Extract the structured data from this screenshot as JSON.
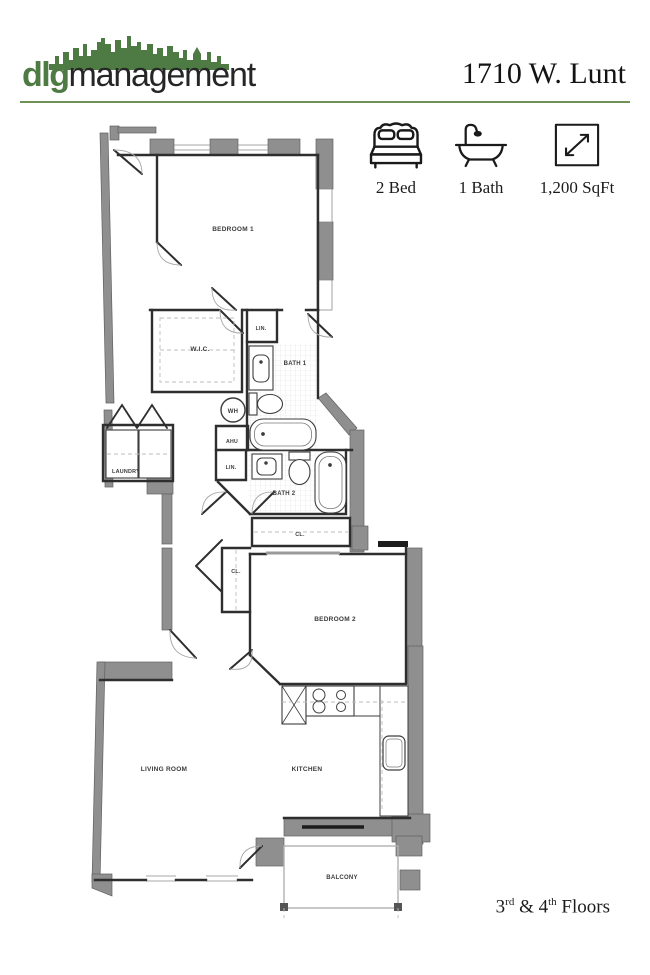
{
  "header": {
    "logo_bold": "dlg",
    "logo_rest": "management",
    "title": "1710 W. Lunt"
  },
  "features": [
    {
      "icon": "bed-icon",
      "label": "2 Bed"
    },
    {
      "icon": "bathtub-icon",
      "label": "1 Bath"
    },
    {
      "icon": "dimensions-icon",
      "label": "1,200 SqFt"
    }
  ],
  "floorplan": {
    "labels": {
      "bedroom1": "BEDROOM 1",
      "wic": "W.I.C.",
      "lin1": "LIN.",
      "bath1": "BATH 1",
      "wh": "WH",
      "ahu": "AHU",
      "laundry": "LAUNDRY",
      "lin2": "LIN.",
      "bath2": "BATH 2",
      "cl1": "CL.",
      "cl2": "CL.",
      "bedroom2": "BEDROOM 2",
      "living_room": "LIVING ROOM",
      "kitchen": "KITCHEN",
      "balcony": "BALCONY"
    }
  },
  "footer": {
    "floor_num_1": "3",
    "floor_sup_1": "rd",
    "separator": " & ",
    "floor_num_2": "4",
    "floor_sup_2": "th",
    "suffix": " Floors"
  },
  "palette": {
    "brand_green": "#4e7b44",
    "rule_green": "#6f9257",
    "wall_gray": "#8f8f8f",
    "line_dark": "#2e2e2e",
    "text_dark": "#1a1a1a"
  }
}
